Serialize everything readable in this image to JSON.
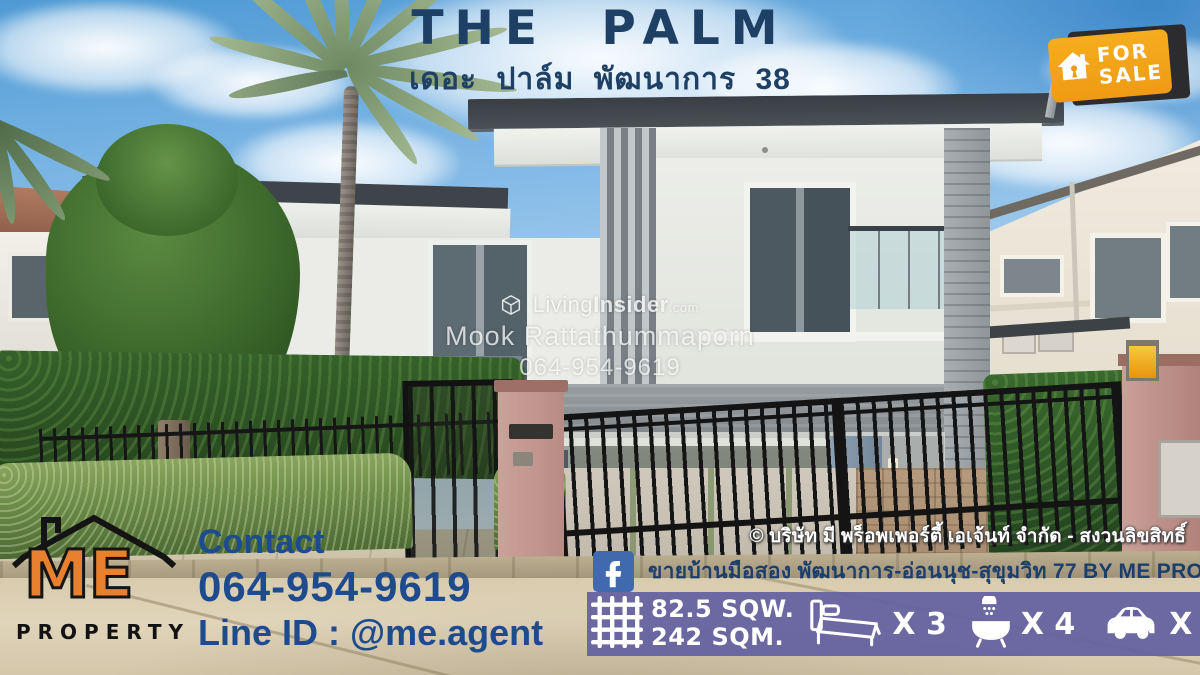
{
  "colors": {
    "title_navy": "#1F4065",
    "contact_blue": "#1D4B8D",
    "me_orange": "#E8802F",
    "sale_yellow": "#F2A41D",
    "facebook_blue": "#4169AD",
    "specs_purple": "#6462A1",
    "watermark_white": "#FFFFFF"
  },
  "header": {
    "title": "THE PALM",
    "subtitle_thai": "เดอะ ปาล์ม พัฒนาการ 38"
  },
  "sale_badge": {
    "line1": "FOR",
    "line2": "SALE"
  },
  "watermark": {
    "brand_prefix": "Living",
    "brand_bold": "Insider",
    "brand_domain": ".com",
    "agent_name": "Mook Rattathummaporn",
    "agent_phone": "064-954-9619"
  },
  "agency": {
    "logo_top": "ME",
    "logo_bottom": "PROPERTY"
  },
  "contact": {
    "heading": "Contact",
    "phone": "064-954-9619",
    "line_id": "Line ID : @me.agent"
  },
  "footer": {
    "copyright": "© บริษัท มี พร็อพเพอร์ตี้ เอเจ้นท์ จำกัด - สงวนลิขสิทธิ์",
    "facebook_page": "ขายบ้านมือสอง พัฒนาการ-อ่อนนุช-สุขุมวิท 77 BY ME PROPERTY AGENT"
  },
  "specs": {
    "land_area": "82.5 SQW.",
    "usable_area": "242 SQM.",
    "bedrooms": "X 3",
    "bathrooms": "X 4",
    "parking": "X 2"
  }
}
